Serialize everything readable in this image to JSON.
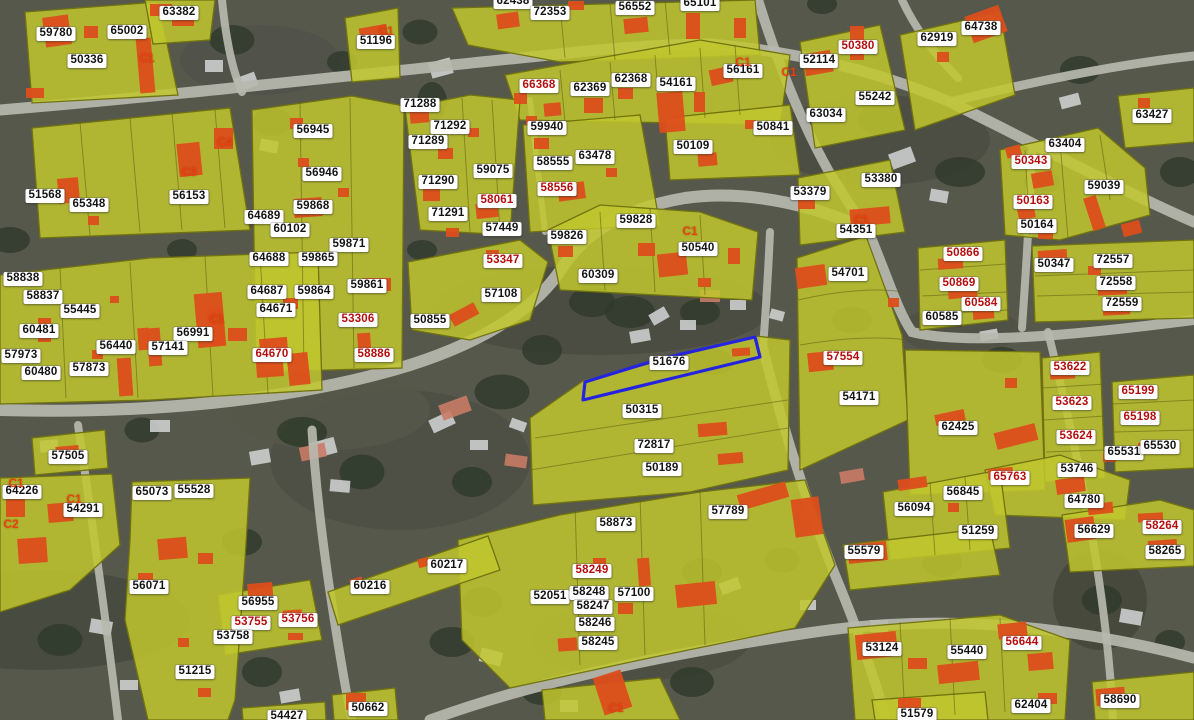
{
  "map": {
    "type": "cadastral-parcel-map-over-aerial-imagery",
    "selected_parcel": "51676",
    "colors": {
      "ground": "#57584c",
      "trees": "#2e3a2a",
      "house": "#d3d6d6",
      "parcel_fill": "#c1c72e",
      "parcel_stroke": "#71730f",
      "building": "#dd4e1b",
      "road": "#b7b8ae",
      "selection": "#2424e0",
      "label_bg": "#ffffff",
      "label_text": "#141414",
      "label_red": "#b50d0d",
      "marker_red": "#e8430f"
    },
    "selection_polygon": "585,382 660,359 755,337 760,357 665,380 583,400",
    "labels": [
      {
        "t": "59780",
        "x": 56,
        "y": 34
      },
      {
        "t": "65002",
        "x": 127,
        "y": 32
      },
      {
        "t": "50336",
        "x": 87,
        "y": 61
      },
      {
        "t": "63382",
        "x": 179,
        "y": 13
      },
      {
        "t": "51196",
        "x": 376,
        "y": 42
      },
      {
        "t": "62438",
        "x": 513,
        "y": 2
      },
      {
        "t": "72353",
        "x": 550,
        "y": 13
      },
      {
        "t": "56552",
        "x": 635,
        "y": 8
      },
      {
        "t": "65101",
        "x": 700,
        "y": 4
      },
      {
        "t": "50380",
        "x": 858,
        "y": 47,
        "r": 1
      },
      {
        "t": "52114",
        "x": 819,
        "y": 61
      },
      {
        "t": "55242",
        "x": 875,
        "y": 98
      },
      {
        "t": "63034",
        "x": 826,
        "y": 115
      },
      {
        "t": "62919",
        "x": 937,
        "y": 39
      },
      {
        "t": "64738",
        "x": 981,
        "y": 28
      },
      {
        "t": "63427",
        "x": 1152,
        "y": 116
      },
      {
        "t": "66368",
        "x": 539,
        "y": 86,
        "r": 1
      },
      {
        "t": "62369",
        "x": 590,
        "y": 89
      },
      {
        "t": "62368",
        "x": 631,
        "y": 80
      },
      {
        "t": "54161",
        "x": 676,
        "y": 84
      },
      {
        "t": "56161",
        "x": 743,
        "y": 71
      },
      {
        "t": "71288",
        "x": 420,
        "y": 105
      },
      {
        "t": "71292",
        "x": 450,
        "y": 127
      },
      {
        "t": "71289",
        "x": 428,
        "y": 142
      },
      {
        "t": "59940",
        "x": 547,
        "y": 128
      },
      {
        "t": "59075",
        "x": 493,
        "y": 171
      },
      {
        "t": "71290",
        "x": 438,
        "y": 182
      },
      {
        "t": "58555",
        "x": 553,
        "y": 163
      },
      {
        "t": "63478",
        "x": 595,
        "y": 157
      },
      {
        "t": "50109",
        "x": 693,
        "y": 147
      },
      {
        "t": "50841",
        "x": 773,
        "y": 128
      },
      {
        "t": "58556",
        "x": 557,
        "y": 189,
        "r": 1
      },
      {
        "t": "58061",
        "x": 497,
        "y": 201,
        "r": 1
      },
      {
        "t": "71291",
        "x": 448,
        "y": 214
      },
      {
        "t": "57449",
        "x": 502,
        "y": 229
      },
      {
        "t": "59828",
        "x": 636,
        "y": 221
      },
      {
        "t": "59826",
        "x": 567,
        "y": 237
      },
      {
        "t": "56945",
        "x": 313,
        "y": 131
      },
      {
        "t": "56153",
        "x": 189,
        "y": 197
      },
      {
        "t": "51568",
        "x": 45,
        "y": 196
      },
      {
        "t": "65348",
        "x": 89,
        "y": 205
      },
      {
        "t": "56946",
        "x": 322,
        "y": 174
      },
      {
        "t": "59868",
        "x": 313,
        "y": 207
      },
      {
        "t": "64689",
        "x": 264,
        "y": 217
      },
      {
        "t": "60102",
        "x": 290,
        "y": 230
      },
      {
        "t": "53380",
        "x": 881,
        "y": 180
      },
      {
        "t": "53379",
        "x": 810,
        "y": 193
      },
      {
        "t": "59039",
        "x": 1104,
        "y": 187
      },
      {
        "t": "63404",
        "x": 1065,
        "y": 145
      },
      {
        "t": "50343",
        "x": 1031,
        "y": 162,
        "r": 1
      },
      {
        "t": "50163",
        "x": 1033,
        "y": 202,
        "r": 1
      },
      {
        "t": "50164",
        "x": 1037,
        "y": 226
      },
      {
        "t": "54351",
        "x": 856,
        "y": 231
      },
      {
        "t": "59871",
        "x": 349,
        "y": 245
      },
      {
        "t": "64688",
        "x": 269,
        "y": 259
      },
      {
        "t": "59865",
        "x": 318,
        "y": 259
      },
      {
        "t": "58838",
        "x": 23,
        "y": 279
      },
      {
        "t": "58837",
        "x": 43,
        "y": 297
      },
      {
        "t": "55445",
        "x": 80,
        "y": 311
      },
      {
        "t": "64687",
        "x": 267,
        "y": 292
      },
      {
        "t": "59864",
        "x": 314,
        "y": 292
      },
      {
        "t": "59861",
        "x": 367,
        "y": 286
      },
      {
        "t": "64671",
        "x": 276,
        "y": 310
      },
      {
        "t": "53306",
        "x": 358,
        "y": 320,
        "r": 1
      },
      {
        "t": "60481",
        "x": 39,
        "y": 331
      },
      {
        "t": "56991",
        "x": 193,
        "y": 334
      },
      {
        "t": "56440",
        "x": 116,
        "y": 347
      },
      {
        "t": "57141",
        "x": 168,
        "y": 348
      },
      {
        "t": "57973",
        "x": 21,
        "y": 356
      },
      {
        "t": "64670",
        "x": 272,
        "y": 355,
        "r": 1
      },
      {
        "t": "58886",
        "x": 374,
        "y": 355,
        "r": 1
      },
      {
        "t": "60480",
        "x": 41,
        "y": 373
      },
      {
        "t": "57873",
        "x": 89,
        "y": 369
      },
      {
        "t": "53347",
        "x": 503,
        "y": 261,
        "r": 1
      },
      {
        "t": "57108",
        "x": 501,
        "y": 295
      },
      {
        "t": "50855",
        "x": 430,
        "y": 321
      },
      {
        "t": "50540",
        "x": 698,
        "y": 249
      },
      {
        "t": "60309",
        "x": 598,
        "y": 276
      },
      {
        "t": "51676",
        "x": 669,
        "y": 363
      },
      {
        "t": "50315",
        "x": 642,
        "y": 411
      },
      {
        "t": "72817",
        "x": 654,
        "y": 446
      },
      {
        "t": "50189",
        "x": 662,
        "y": 469
      },
      {
        "t": "54701",
        "x": 848,
        "y": 274
      },
      {
        "t": "50866",
        "x": 963,
        "y": 254,
        "r": 1
      },
      {
        "t": "50347",
        "x": 1054,
        "y": 265
      },
      {
        "t": "72557",
        "x": 1113,
        "y": 261
      },
      {
        "t": "72558",
        "x": 1116,
        "y": 283
      },
      {
        "t": "72559",
        "x": 1122,
        "y": 304
      },
      {
        "t": "50869",
        "x": 959,
        "y": 284,
        "r": 1
      },
      {
        "t": "60584",
        "x": 981,
        "y": 304,
        "r": 1
      },
      {
        "t": "60585",
        "x": 942,
        "y": 318
      },
      {
        "t": "57554",
        "x": 843,
        "y": 358,
        "r": 1
      },
      {
        "t": "54171",
        "x": 859,
        "y": 398
      },
      {
        "t": "53622",
        "x": 1070,
        "y": 368,
        "r": 1
      },
      {
        "t": "53623",
        "x": 1072,
        "y": 403,
        "r": 1
      },
      {
        "t": "65199",
        "x": 1138,
        "y": 392,
        "r": 1
      },
      {
        "t": "65198",
        "x": 1140,
        "y": 418,
        "r": 1
      },
      {
        "t": "62425",
        "x": 958,
        "y": 428
      },
      {
        "t": "53624",
        "x": 1076,
        "y": 437,
        "r": 1
      },
      {
        "t": "65531",
        "x": 1124,
        "y": 453
      },
      {
        "t": "65530",
        "x": 1160,
        "y": 447
      },
      {
        "t": "53746",
        "x": 1077,
        "y": 470
      },
      {
        "t": "65763",
        "x": 1010,
        "y": 478,
        "r": 1
      },
      {
        "t": "57505",
        "x": 68,
        "y": 457
      },
      {
        "t": "64226",
        "x": 22,
        "y": 492
      },
      {
        "t": "54291",
        "x": 83,
        "y": 510
      },
      {
        "t": "65073",
        "x": 152,
        "y": 493
      },
      {
        "t": "55528",
        "x": 194,
        "y": 491
      },
      {
        "t": "56071",
        "x": 149,
        "y": 587
      },
      {
        "t": "60216",
        "x": 370,
        "y": 587
      },
      {
        "t": "56955",
        "x": 258,
        "y": 603
      },
      {
        "t": "53755",
        "x": 251,
        "y": 623,
        "r": 1
      },
      {
        "t": "53756",
        "x": 298,
        "y": 620,
        "r": 1
      },
      {
        "t": "53758",
        "x": 233,
        "y": 637
      },
      {
        "t": "51215",
        "x": 195,
        "y": 672
      },
      {
        "t": "50662",
        "x": 368,
        "y": 709
      },
      {
        "t": "54427",
        "x": 287,
        "y": 717
      },
      {
        "t": "58873",
        "x": 616,
        "y": 524
      },
      {
        "t": "57789",
        "x": 728,
        "y": 512
      },
      {
        "t": "60217",
        "x": 447,
        "y": 566
      },
      {
        "t": "58249",
        "x": 592,
        "y": 571,
        "r": 1
      },
      {
        "t": "52051",
        "x": 550,
        "y": 597
      },
      {
        "t": "58248",
        "x": 589,
        "y": 593
      },
      {
        "t": "57100",
        "x": 634,
        "y": 594
      },
      {
        "t": "58247",
        "x": 593,
        "y": 607
      },
      {
        "t": "58246",
        "x": 595,
        "y": 624
      },
      {
        "t": "58245",
        "x": 598,
        "y": 643
      },
      {
        "t": "56845",
        "x": 963,
        "y": 493
      },
      {
        "t": "56094",
        "x": 914,
        "y": 509
      },
      {
        "t": "64780",
        "x": 1084,
        "y": 501
      },
      {
        "t": "51259",
        "x": 978,
        "y": 532
      },
      {
        "t": "56629",
        "x": 1094,
        "y": 531
      },
      {
        "t": "58264",
        "x": 1162,
        "y": 527,
        "r": 1
      },
      {
        "t": "58265",
        "x": 1165,
        "y": 552
      },
      {
        "t": "55579",
        "x": 864,
        "y": 552
      },
      {
        "t": "53124",
        "x": 882,
        "y": 649
      },
      {
        "t": "55440",
        "x": 967,
        "y": 652
      },
      {
        "t": "56644",
        "x": 1022,
        "y": 643,
        "r": 1
      },
      {
        "t": "62404",
        "x": 1031,
        "y": 706
      },
      {
        "t": "58690",
        "x": 1120,
        "y": 701
      },
      {
        "t": "51579",
        "x": 917,
        "y": 715
      }
    ],
    "markers": [
      {
        "t": "C1",
        "x": 147,
        "y": 58
      },
      {
        "t": "C1",
        "x": 386,
        "y": 31
      },
      {
        "t": "C4",
        "x": 225,
        "y": 142
      },
      {
        "t": "C3",
        "x": 189,
        "y": 172
      },
      {
        "t": "C1",
        "x": 743,
        "y": 62
      },
      {
        "t": "C1",
        "x": 789,
        "y": 72
      },
      {
        "t": "C1",
        "x": 690,
        "y": 231
      },
      {
        "t": "C1",
        "x": 861,
        "y": 220
      },
      {
        "t": "C1",
        "x": 217,
        "y": 319
      },
      {
        "t": "C1",
        "x": 16,
        "y": 483
      },
      {
        "t": "C1",
        "x": 74,
        "y": 499
      },
      {
        "t": "C2",
        "x": 11,
        "y": 524
      },
      {
        "t": "C1",
        "x": 616,
        "y": 708
      }
    ]
  }
}
